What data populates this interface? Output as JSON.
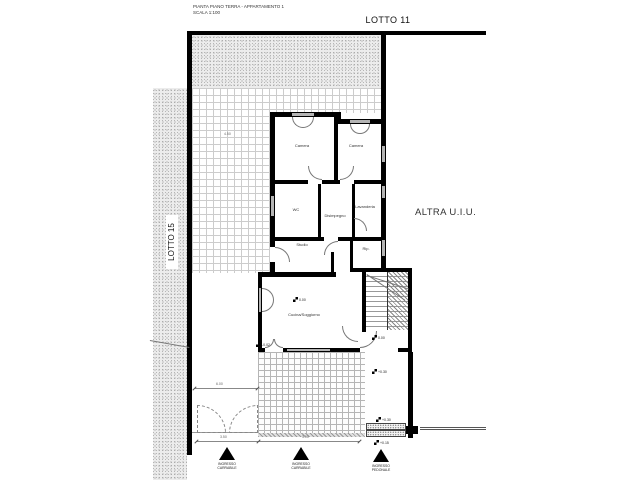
{
  "drawing": {
    "title_line1": "PIANTA PIANO TERRA - APPARTAMENTO 1",
    "title_line2": "SCALA 1:100"
  },
  "labels": {
    "lotto11": "LOTTO 11",
    "lotto15": "LOTTO 15",
    "altra_uiu": "ALTRA U.I.U."
  },
  "rooms": {
    "camera1": "Camera",
    "camera2": "Camera",
    "wc": "WC",
    "disimpegno": "Disimpegno",
    "lavanderia": "Lavanderia",
    "studio": "Studio",
    "ripostiglio": "Rip.",
    "soggiorno": "Cucina/Soggiorno"
  },
  "levels": {
    "soggiorno": "0.00",
    "ingresso": "0.00",
    "porch": "+0.30",
    "patio": "-0.02",
    "step_top": "+0.30",
    "step_bottom": "+0.15"
  },
  "dimensions": {
    "garden": "4.50",
    "driveway": "6.00",
    "gate_left": "3.50",
    "gate_right": "3.00"
  },
  "entrances": [
    {
      "line1": "INGRESSO",
      "line2": "CARRABILE"
    },
    {
      "line1": "INGRESSO",
      "line2": "CARRABILE"
    },
    {
      "line1": "INGRESSO",
      "line2": "PEDONALE"
    }
  ],
  "colors": {
    "wall": "#000000",
    "tile_line": "#cccccc",
    "stipple_dot": "#8f8f8f",
    "window_fill": "#b4b4b4"
  }
}
